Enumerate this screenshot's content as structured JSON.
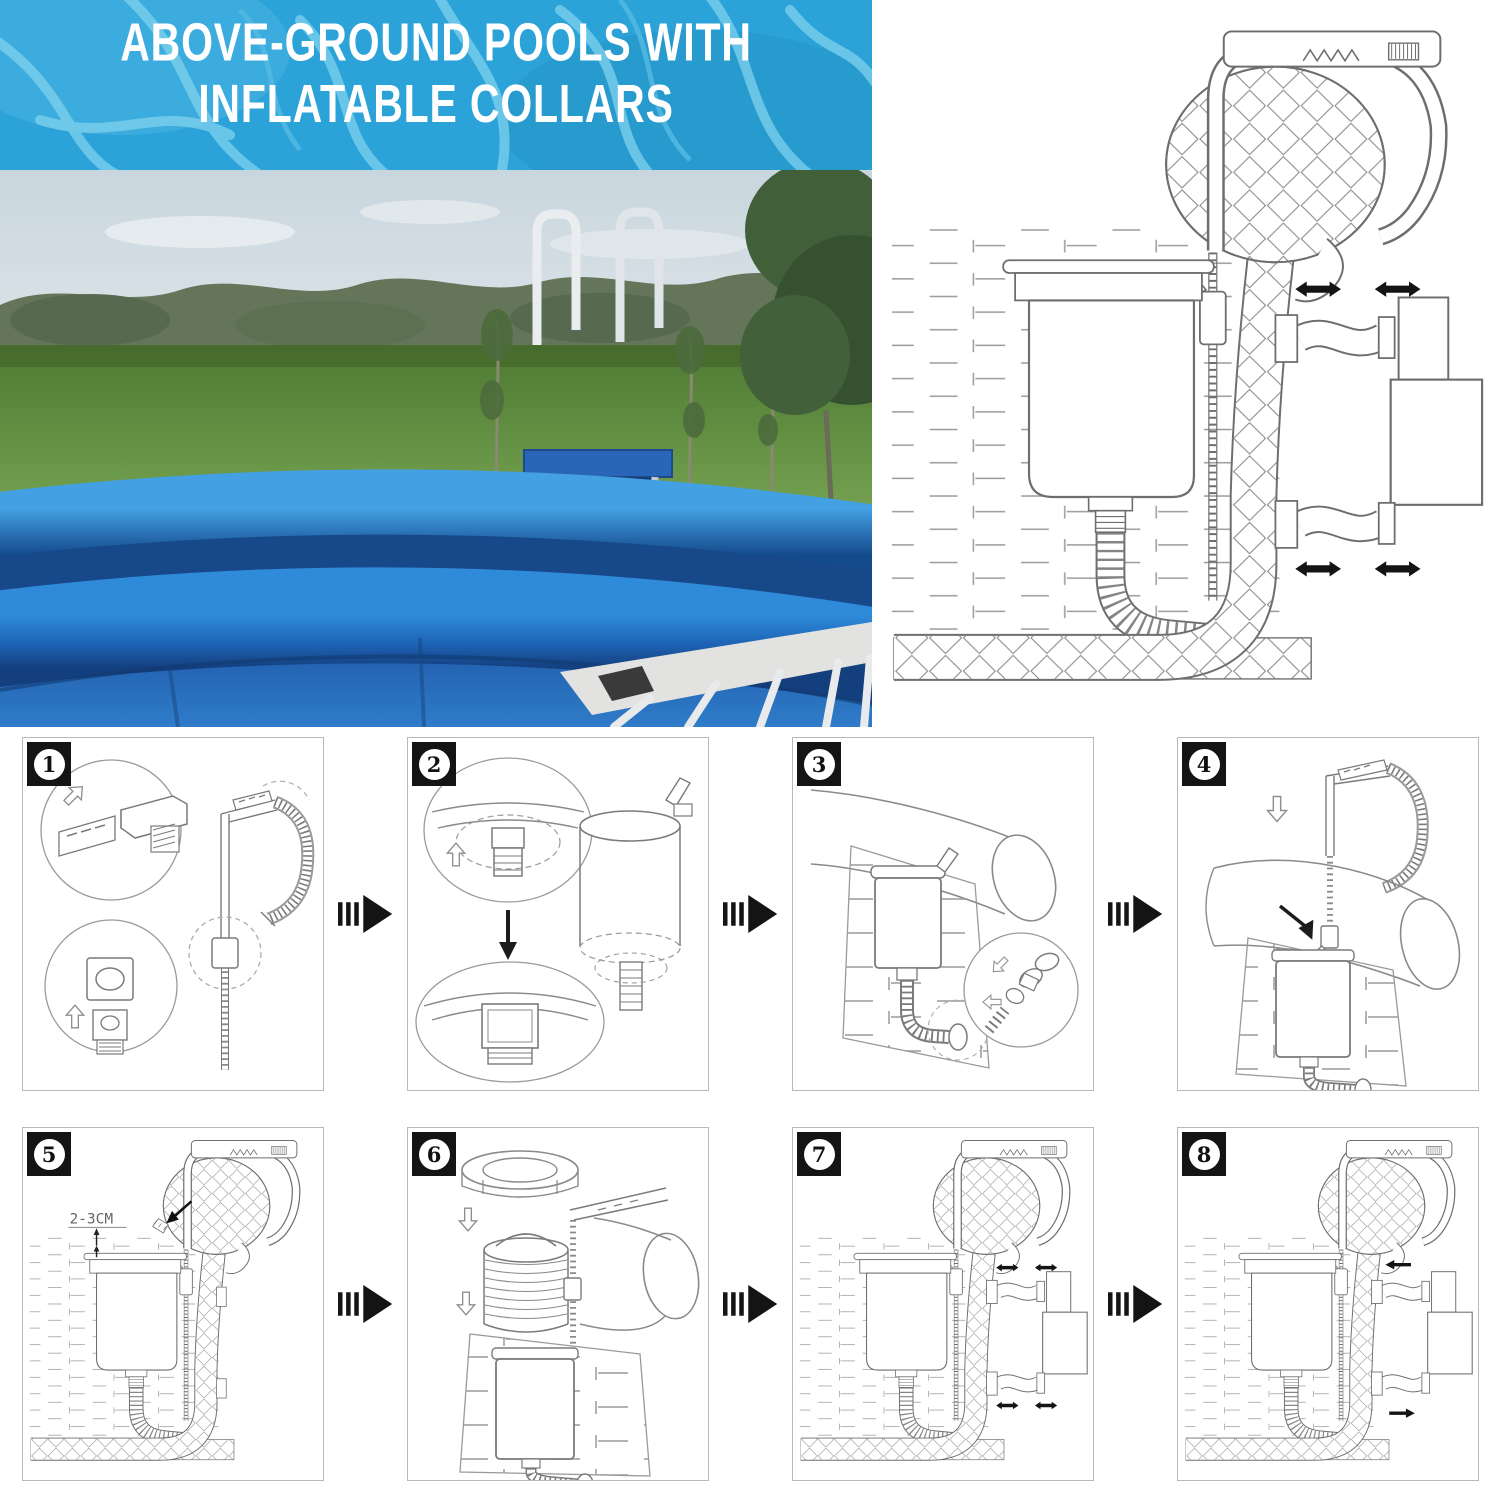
{
  "banner": {
    "title_line1": "ABOVE-GROUND POOLS WITH",
    "title_line2": "INFLATABLE COLLARS",
    "background_color": "#2ba2d8",
    "pattern_color": "#7fd2ee",
    "text_color": "#ffffff"
  },
  "photo": {
    "alt": "Blue above-ground pool with inflatable collar, ladder, grass field and trees"
  },
  "main_diagram": {
    "alt": "Cross-section: skimmer hung on inflatable collar, hose through wall to pump",
    "flow_arrow_icon": "double-headed-arrow"
  },
  "steps": [
    {
      "number": "1"
    },
    {
      "number": "2"
    },
    {
      "number": "3"
    },
    {
      "number": "4"
    },
    {
      "number": "5",
      "annotation": "2-3CM"
    },
    {
      "number": "6"
    },
    {
      "number": "7"
    },
    {
      "number": "8"
    }
  ],
  "icons": {
    "step_separator": "fast-forward-arrow",
    "hollow_arrow": "outline-arrow",
    "flow_double_arrow": "double-headed-arrow",
    "flow_single_arrow": "single-arrow"
  },
  "line_art": {
    "stroke_color": "#6e6e6e",
    "badge_color": "#141414",
    "pool_blue": "#1d5cab",
    "ring_blue": "#2e85d6"
  }
}
